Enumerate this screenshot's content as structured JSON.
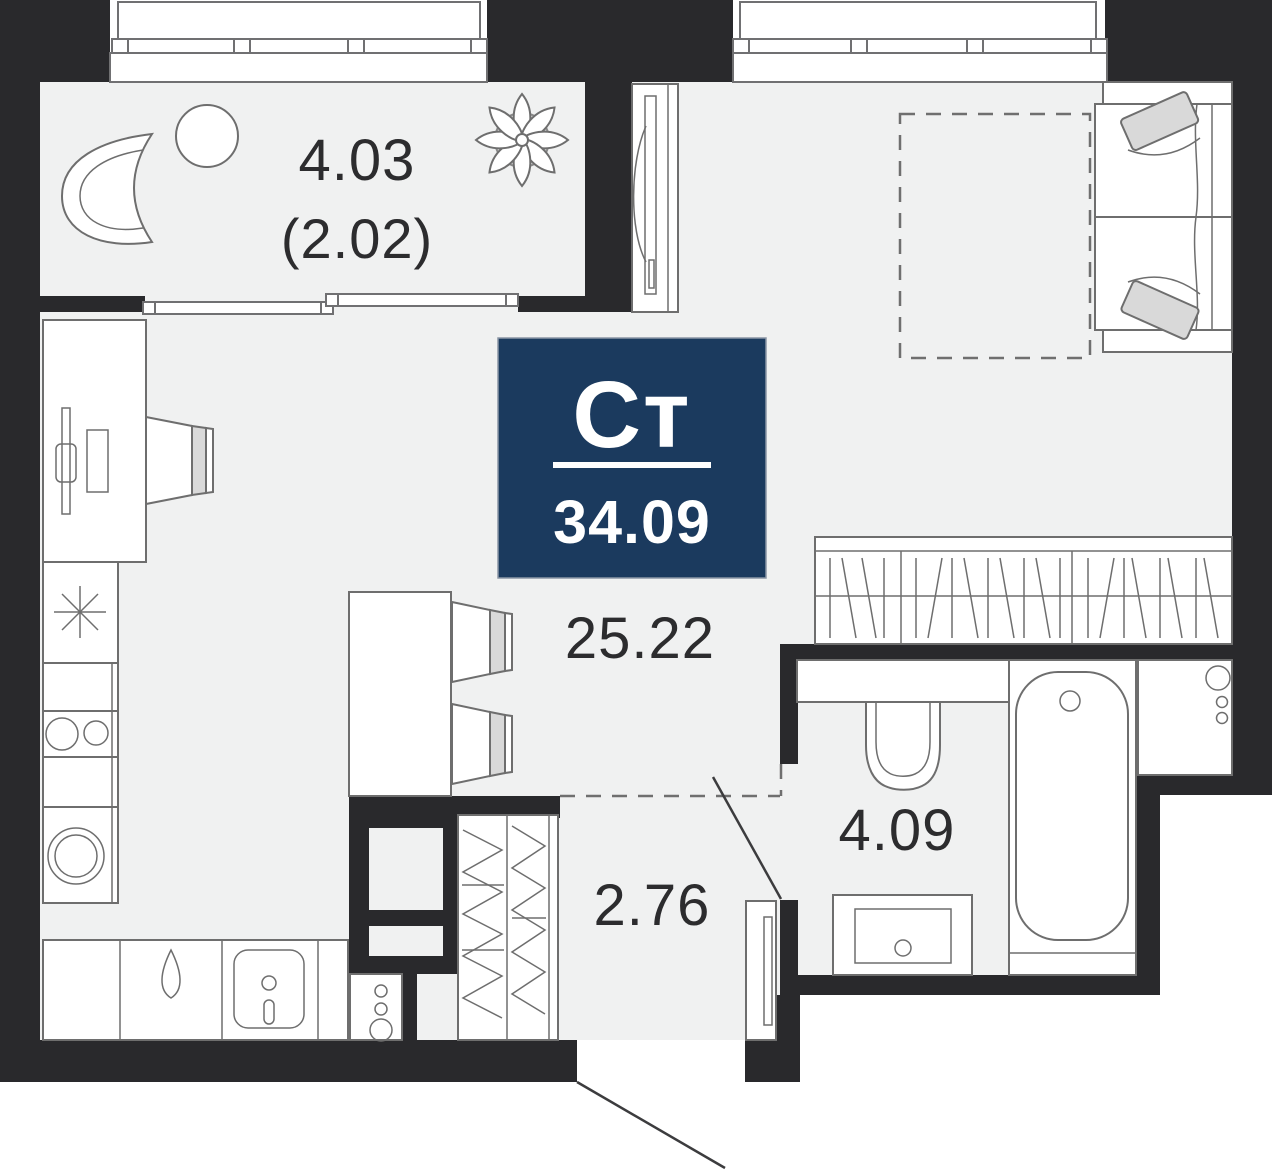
{
  "badge": {
    "type_label": "Ст",
    "area_value": "34.09",
    "bg_color": "#1b3a5e"
  },
  "rooms": {
    "balcony": {
      "area": "4.03",
      "area_secondary": "(2.02)"
    },
    "living_room": {
      "area": "25.22"
    },
    "hallway": {
      "area": "2.76"
    },
    "bathroom": {
      "area": "4.09"
    }
  },
  "colors": {
    "wall": "#29292c",
    "floor": "#f0f1f1",
    "line": "#6e6e6e",
    "accent": "#d9d9d9",
    "swing": "#3c3c3e",
    "label": "#2c2c2e"
  }
}
